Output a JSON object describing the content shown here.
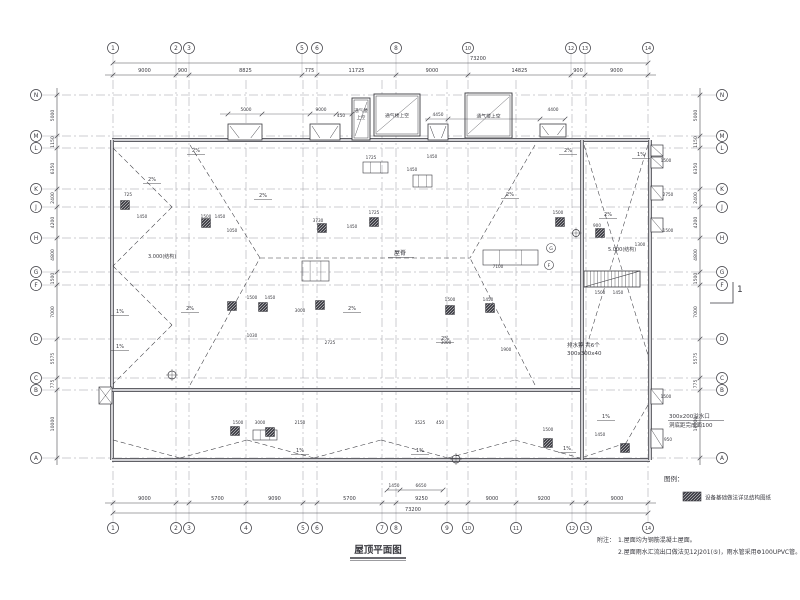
{
  "colors": {
    "ink": "#3a3a40",
    "grid": "#9a9aa2",
    "wall_core": "#d2d2d6",
    "dim": "#4a4a50",
    "bg": "#ffffff"
  },
  "title": {
    "text": "屋顶平面图"
  },
  "legend": {
    "heading": "图例：",
    "item": "设备基础做法详见结构图纸"
  },
  "notes": {
    "heading": "附注：",
    "lines": [
      "1.屋面均为钢筋混凝土屋面。",
      "2.屋面雨水汇流出口做法见12J201(⑤)，雨水管采用Φ100UPVC管。"
    ]
  },
  "section_marker": {
    "label": "1"
  },
  "grid": {
    "top": {
      "bubbles": [
        [
          "1",
          113
        ],
        [
          "2",
          176
        ],
        [
          "3",
          189
        ],
        [
          "5",
          302
        ],
        [
          "6",
          317
        ],
        [
          "8",
          396
        ],
        [
          "10",
          468
        ],
        [
          "12",
          571
        ],
        [
          "13",
          585
        ],
        [
          "14",
          648
        ]
      ],
      "dims": [
        [
          "9000",
          113,
          176
        ],
        [
          "900",
          176,
          189
        ],
        [
          "8825",
          189,
          302
        ],
        [
          "775",
          302,
          317
        ],
        [
          "11725",
          317,
          396
        ],
        [
          "9000",
          396,
          468
        ],
        [
          "14825",
          468,
          571
        ],
        [
          "900",
          571,
          585
        ],
        [
          "9000",
          585,
          648
        ]
      ],
      "overall": [
        "73200",
        113,
        648,
        478
      ]
    },
    "bottom": {
      "bubbles": [
        [
          "1",
          113
        ],
        [
          "2",
          176
        ],
        [
          "3",
          189
        ],
        [
          "4",
          246
        ],
        [
          "5",
          303
        ],
        [
          "6",
          317
        ],
        [
          "7",
          382
        ],
        [
          "8",
          396
        ],
        [
          "9",
          447
        ],
        [
          "10",
          468
        ],
        [
          "11",
          516
        ],
        [
          "12",
          572
        ],
        [
          "13",
          586
        ],
        [
          "14",
          648
        ]
      ],
      "dims": [
        [
          "9000",
          113,
          176
        ],
        [
          "5700",
          189,
          246
        ],
        [
          "9090",
          246,
          303
        ],
        [
          "5700",
          317,
          382
        ],
        [
          "9250",
          396,
          447
        ],
        [
          "9000",
          468,
          516
        ],
        [
          "9200",
          516,
          572
        ],
        [
          "9000",
          586,
          648
        ]
      ],
      "overall": [
        "73200",
        113,
        648,
        413
      ]
    },
    "left": {
      "bubbles": [
        [
          "N",
          95
        ],
        [
          "M",
          136
        ],
        [
          "L",
          148
        ],
        [
          "K",
          189
        ],
        [
          "J",
          207
        ],
        [
          "H",
          238
        ],
        [
          "G",
          272
        ],
        [
          "F",
          285
        ],
        [
          "D",
          339
        ],
        [
          "C",
          378
        ],
        [
          "B",
          390
        ],
        [
          "A",
          458
        ]
      ],
      "dims": [
        [
          "5000",
          95,
          136
        ],
        [
          "1150",
          136,
          148
        ],
        [
          "6350",
          148,
          189
        ],
        [
          "2400",
          189,
          207
        ],
        [
          "4200",
          207,
          238
        ],
        [
          "4800",
          238,
          272
        ],
        [
          "1500",
          272,
          285
        ],
        [
          "7000",
          285,
          339
        ],
        [
          "5575",
          339,
          378
        ],
        [
          "775",
          378,
          390
        ],
        [
          "10000",
          390,
          458
        ]
      ]
    },
    "right": {
      "bubbles": [
        [
          "N",
          95
        ],
        [
          "M",
          136
        ],
        [
          "L",
          148
        ],
        [
          "K",
          189
        ],
        [
          "J",
          207
        ],
        [
          "H",
          238
        ],
        [
          "G",
          272
        ],
        [
          "F",
          285
        ],
        [
          "D",
          339
        ],
        [
          "C",
          378
        ],
        [
          "B",
          390
        ],
        [
          "A",
          458
        ]
      ],
      "dims": [
        [
          "5000",
          95,
          136
        ],
        [
          "1150",
          136,
          148
        ],
        [
          "6350",
          148,
          189
        ],
        [
          "2400",
          189,
          207
        ],
        [
          "4200",
          207,
          238
        ],
        [
          "4800",
          238,
          272
        ],
        [
          "1500",
          272,
          285
        ],
        [
          "7000",
          285,
          339
        ],
        [
          "5575",
          339,
          378
        ],
        [
          "775",
          378,
          390
        ],
        [
          "10000",
          390,
          458
        ]
      ]
    }
  },
  "vents": {
    "boxes": [
      {
        "label": "通气楼上空",
        "x": 352,
        "y": 98,
        "w": 18,
        "h": 42,
        "vertical": true
      },
      {
        "label": "通气楼上空",
        "x": 374,
        "y": 94,
        "w": 46,
        "h": 42,
        "vertical": false
      },
      {
        "label": "通气楼上空",
        "x": 465,
        "y": 93,
        "w": 47,
        "h": 45,
        "vertical": false
      }
    ],
    "dims": [
      [
        "5000",
        246,
        111
      ],
      [
        "9000",
        321,
        111
      ],
      [
        "450",
        341,
        117
      ],
      [
        "4450",
        438,
        116
      ],
      [
        "4400",
        553,
        111
      ]
    ]
  },
  "annotations": {
    "ridge": {
      "text": "屋脊"
    },
    "drain_grate": {
      "line1": "排水箅 共6个",
      "line2": "300x300x40"
    },
    "overflow": {
      "line1": "300x200溢水口",
      "line2": "洞底距完成面100"
    },
    "elev1": {
      "text": "3.000(结构)"
    },
    "elev2": {
      "text": "5.000(结构)"
    },
    "inner_bubbles": [
      [
        "G",
        551,
        248
      ],
      [
        "F",
        549,
        265
      ]
    ],
    "slopes": [
      [
        "2%",
        152,
        181
      ],
      [
        "2%",
        196,
        152
      ],
      [
        "2%",
        263,
        197
      ],
      [
        "2%",
        510,
        196
      ],
      [
        "2%",
        568,
        152
      ],
      [
        "1%",
        641,
        156
      ],
      [
        "2%",
        608,
        216
      ],
      [
        "1%",
        120,
        313
      ],
      [
        "2%",
        190,
        310
      ],
      [
        "1%",
        120,
        348
      ],
      [
        "1%",
        567,
        450
      ],
      [
        "1%",
        606,
        418
      ],
      [
        "1%",
        300,
        452
      ],
      [
        "1%",
        420,
        452
      ],
      [
        "2%",
        352,
        310
      ],
      [
        "2%",
        445,
        340
      ]
    ],
    "sub_dims": [
      [
        "1450",
        394,
        487
      ],
      [
        "6650",
        421,
        487
      ]
    ],
    "micro_dims": [
      [
        206,
        218,
        "1500"
      ],
      [
        220,
        218,
        "1450"
      ],
      [
        232,
        232,
        "1050"
      ],
      [
        318,
        222,
        "3730"
      ],
      [
        352,
        228,
        "1450"
      ],
      [
        374,
        214,
        "1725"
      ],
      [
        412,
        171,
        "1450"
      ],
      [
        371,
        159,
        "1725"
      ],
      [
        432,
        158,
        "1450"
      ],
      [
        558,
        214,
        "1500"
      ],
      [
        597,
        227,
        "900"
      ],
      [
        640,
        246,
        "1300"
      ],
      [
        252,
        299,
        "1500"
      ],
      [
        270,
        299,
        "1450"
      ],
      [
        300,
        312,
        "3000"
      ],
      [
        330,
        344,
        "2725"
      ],
      [
        252,
        337,
        "1030"
      ],
      [
        450,
        301,
        "1500"
      ],
      [
        488,
        301,
        "1450"
      ],
      [
        446,
        344,
        "3000"
      ],
      [
        506,
        351,
        "1900"
      ],
      [
        498,
        268,
        "7100"
      ],
      [
        238,
        424,
        "1500"
      ],
      [
        260,
        424,
        "3000"
      ],
      [
        300,
        424,
        "2150"
      ],
      [
        420,
        424,
        "3525"
      ],
      [
        440,
        424,
        "450"
      ],
      [
        548,
        431,
        "1500"
      ],
      [
        600,
        436,
        "1450"
      ],
      [
        128,
        196,
        "725"
      ],
      [
        142,
        218,
        "1450"
      ],
      [
        666,
        162,
        "1500"
      ],
      [
        668,
        196,
        "2750"
      ],
      [
        668,
        232,
        "1500"
      ],
      [
        666,
        398,
        "1500"
      ],
      [
        668,
        441,
        "950"
      ],
      [
        600,
        294,
        "1500"
      ],
      [
        618,
        294,
        "1450"
      ]
    ]
  }
}
